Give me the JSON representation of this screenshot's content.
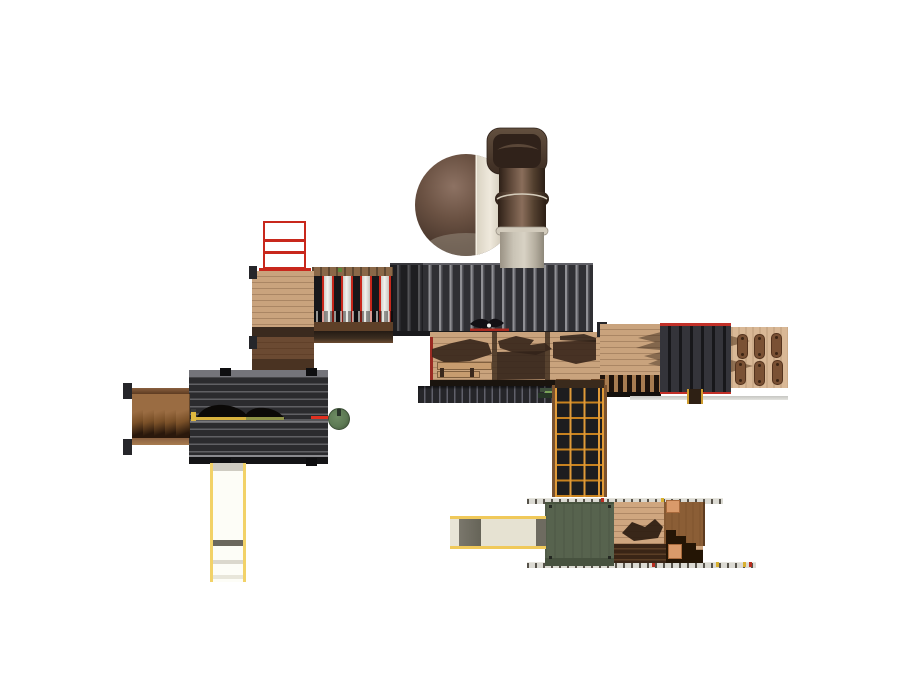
{
  "scene": {
    "title": "playground-structure-top-view-3d-render",
    "view": "top-down plan view of a modular playground set on a white background",
    "components": [
      {
        "name": "tube-slide",
        "label": "curved tube slide, brown and cream"
      },
      {
        "name": "main-roof",
        "label": "dark ribbed pitched roof"
      },
      {
        "name": "ridge-ornament",
        "label": "bird ornament with red ridge bar"
      },
      {
        "name": "red-ladder",
        "label": "red overhead ladder frame"
      },
      {
        "name": "slat-bridge",
        "label": "red-and-white vertical slat bridge"
      },
      {
        "name": "entry-ramp",
        "label": "wood entry ramp darkening into shadow"
      },
      {
        "name": "left-platform",
        "label": "dark plank platform with hump climber"
      },
      {
        "name": "stairs",
        "label": "wood access stairs"
      },
      {
        "name": "steering-wheel",
        "label": "green play steering wheel on red stem"
      },
      {
        "name": "straight-slide",
        "label": "straight slide with pale yellow rails"
      },
      {
        "name": "main-deck",
        "label": "wood deck with roof shadows and bench"
      },
      {
        "name": "net-climber",
        "label": "orange grid net climber"
      },
      {
        "name": "green-roof",
        "label": "green flat roof module"
      },
      {
        "name": "lower-deck",
        "label": "lower wood deck with dark steps"
      },
      {
        "name": "crawl-ramp",
        "label": "cream crawl ramp with yellow rails"
      },
      {
        "name": "right-roof",
        "label": "dark ribbed roof block with red trim"
      },
      {
        "name": "climbing-wall",
        "label": "tan climbing wall with hand slots"
      },
      {
        "name": "plank-bridge",
        "label": "plank bridge with rung strip"
      },
      {
        "name": "guard-rail-edges",
        "label": "thin guard-rail edge lines with ticks"
      },
      {
        "name": "ground-shadow",
        "label": "ground contact line"
      }
    ]
  },
  "palette": {
    "background": "#ffffff",
    "roof-dark": "#303034",
    "roof-rib": "#909094",
    "platform-dark": "#2b2b2e",
    "platform-rib": "#606064",
    "wood-light": "#c9a37d",
    "wood-mid": "#8a5f3c",
    "wood-dark": "#4a3322",
    "shadow-brown": "#3a281c",
    "accent-red": "#c8281c",
    "rail-yellow": "#f2d268",
    "orange-grid": "#e09a38",
    "green-disc": "#5d7a54",
    "green-roof": "#57634e",
    "cream": "#e6e2d2",
    "tube-brown": "#564134",
    "tube-cream": "#e9e3d5",
    "wall-tan": "#d9b896",
    "slot-brown": "#7a5134",
    "slat-white": "#ececec",
    "tick-dark": "#56524a",
    "ground-line": "#d6d6d2"
  }
}
